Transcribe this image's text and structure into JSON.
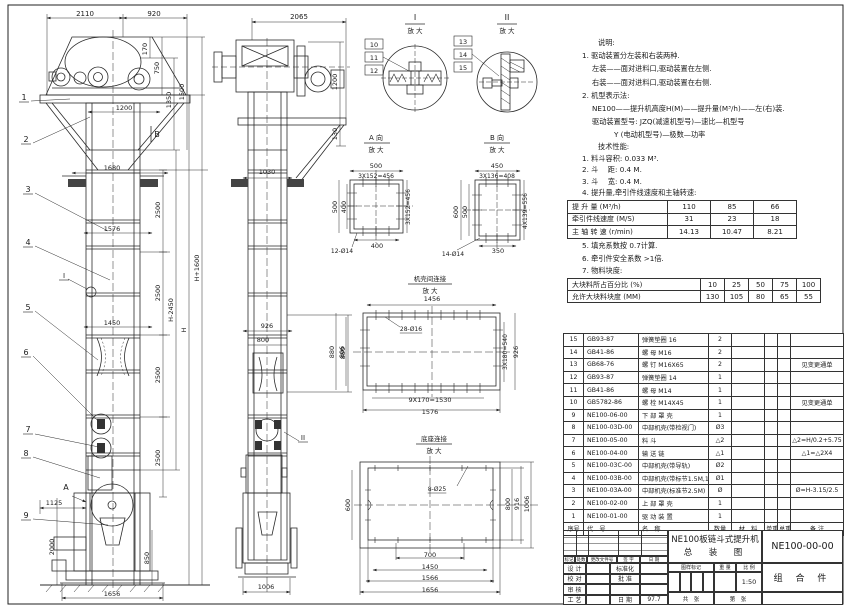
{
  "notes": {
    "title": "说明:",
    "lines": [
      "1. 驱动装置分左装和右装两种.",
      "左装——面对进料口,驱动装置在左侧.",
      "右装——面对进料口,驱动装置在右侧.",
      "2. 机型表示法:",
      "NE100——提升机高度H(M)——提升量(M³/h)——左(右)装.",
      "驱动装置型号: JZQ(减速机型号)—速比—机型号",
      "Y (电动机型号)—极数—功率"
    ]
  },
  "tech": {
    "title": "技术性能:",
    "items": [
      "1. 料斗容积: 0.033 M³.",
      "2. 斗　 距: 0.4 M.",
      "3. 斗　 宽: 0.4 M.",
      "4. 提升量,牵引件线速度和主轴转速:"
    ],
    "items2": [
      "5. 填充系数按 0.7计算.",
      "6. 牵引件安全系数 >1倍.",
      "7. 物料块度:"
    ]
  },
  "perf": {
    "rows": [
      [
        "提 升 量  (M³/h)",
        "110",
        "85",
        "66"
      ],
      [
        "牵引件线速度 (M/S)",
        "31",
        "23",
        "18"
      ],
      [
        "主 轴 转 速 (r/min)",
        "14.13",
        "10.47",
        "8.21"
      ]
    ]
  },
  "size": {
    "rows": [
      [
        "大块料所占百分比 (%)",
        "10",
        "25",
        "50",
        "75",
        "100"
      ],
      [
        "允许大块料块度 (MM)",
        "130",
        "105",
        "80",
        "65",
        "55"
      ]
    ]
  },
  "bom": {
    "rows": [
      [
        "15",
        "GB93-87",
        "弹簧垫圈 16",
        "2",
        "",
        "",
        "",
        ""
      ],
      [
        "14",
        "GB41-86",
        "螺 母 M16",
        "2",
        "",
        "",
        "",
        ""
      ],
      [
        "13",
        "GB68-76",
        "螺 钉 M16X65",
        "2",
        "",
        "",
        "",
        "见变更通单"
      ],
      [
        "12",
        "GB93-87",
        "弹簧垫圈 14",
        "1",
        "",
        "",
        "",
        ""
      ],
      [
        "11",
        "GB41-86",
        "螺 母 M14",
        "1",
        "",
        "",
        "",
        ""
      ],
      [
        "10",
        "GB5782-86",
        "螺 栓 M14X45",
        "1",
        "",
        "",
        "",
        "见变更通单"
      ],
      [
        "9",
        "NE100-06-00",
        "下 部 罩 壳",
        "1",
        "",
        "",
        "",
        ""
      ],
      [
        "8",
        "NE100-03D-00",
        "中部机壳(带检视门)",
        "Ø3",
        "",
        "",
        "",
        ""
      ],
      [
        "7",
        "NE100-05-00",
        "料 斗",
        "△2",
        "",
        "",
        "",
        "△2=H/0.2+5.75"
      ],
      [
        "6",
        "NE100-04-00",
        "输 送 链",
        "△1",
        "",
        "",
        "",
        "△1=△2X4"
      ],
      [
        "5",
        "NE100-03C-00",
        "中部机壳(带导轨)",
        "Ø2",
        "",
        "",
        "",
        ""
      ],
      [
        "4",
        "NE100-03B-00",
        "中部机壳(带标节1.5M,1M)",
        "Ø1",
        "",
        "",
        "",
        ""
      ],
      [
        "3",
        "NE100-03A-00",
        "中部机壳(标准节2.5M)",
        "Ø",
        "",
        "",
        "",
        "Ø=H-3.15/2.5"
      ],
      [
        "2",
        "NE100-02-00",
        "上 部 罩 壳",
        "1",
        "",
        "",
        "",
        ""
      ],
      [
        "1",
        "NE100-01-00",
        "驱 动 装 置",
        "1",
        "",
        "",
        "",
        ""
      ],
      [
        "序号",
        "代　号",
        "名　称",
        "数量",
        "材　料",
        "单重",
        "总重",
        "备 注"
      ]
    ]
  },
  "tb": {
    "mark": "标记",
    "qty": "处数",
    "doc": "更改文件号",
    "sign": "签 字",
    "date": "日 期",
    "design": "设 计",
    "check": "校 对",
    "review": "审 核",
    "craft": "工 艺",
    "std": "标准化",
    "approve": "批 准",
    "date2": "日 期",
    "date_val": "97.7",
    "title1": "NE100板链斗式提升机",
    "title2": "总　装　图",
    "stamp": "图样标记",
    "weight": "重 量",
    "scale_lbl": "比 例",
    "scale": "1:50",
    "sheets": "共　张",
    "sheet_no": "第　张",
    "dwg_no": "NE100-00-00",
    "part": "组 合 件"
  },
  "labels": [
    {
      "x": 85,
      "y": 16,
      "t": "2110"
    },
    {
      "x": 154,
      "y": 16,
      "t": "920"
    },
    {
      "x": 147,
      "y": 49,
      "t": "170",
      "r": 1,
      "fs": 6.5
    },
    {
      "x": 159,
      "y": 68,
      "t": "750",
      "r": 1,
      "fs": 6.5
    },
    {
      "x": 171,
      "y": 100,
      "t": "1350",
      "r": 1,
      "fs": 6.5
    },
    {
      "x": 184,
      "y": 92,
      "t": "1500",
      "r": 1,
      "fs": 6.5
    },
    {
      "x": 124,
      "y": 110,
      "t": "1200",
      "fs": 6.5
    },
    {
      "x": 112,
      "y": 170,
      "t": "1680",
      "fs": 6.5
    },
    {
      "x": 112,
      "y": 231,
      "t": "1576",
      "fs": 6.5
    },
    {
      "x": 112,
      "y": 325,
      "t": "1450",
      "fs": 6.5
    },
    {
      "x": 160,
      "y": 210,
      "t": "2500",
      "r": 1,
      "fs": 6.5
    },
    {
      "x": 160,
      "y": 293,
      "t": "2500",
      "r": 1,
      "fs": 6.5
    },
    {
      "x": 160,
      "y": 375,
      "t": "2500",
      "r": 1,
      "fs": 6.5
    },
    {
      "x": 160,
      "y": 458,
      "t": "2500",
      "r": 1,
      "fs": 6.5
    },
    {
      "x": 173,
      "y": 310,
      "t": "H-2450",
      "r": 1,
      "fs": 6.5
    },
    {
      "x": 186,
      "y": 330,
      "t": "H",
      "r": 1,
      "fs": 6.5
    },
    {
      "x": 199,
      "y": 268,
      "t": "H+1600",
      "r": 1,
      "fs": 6.5
    },
    {
      "x": 54,
      "y": 505,
      "t": "1125",
      "fs": 6.5
    },
    {
      "x": 54,
      "y": 547,
      "t": "2000",
      "r": 1,
      "fs": 6.5
    },
    {
      "x": 149,
      "y": 558,
      "t": "850",
      "r": 1,
      "fs": 6.5
    },
    {
      "x": 112,
      "y": 596,
      "t": "1656",
      "fs": 6.5
    },
    {
      "x": 24,
      "y": 100,
      "t": "1",
      "u": 1,
      "fs": 8
    },
    {
      "x": 26,
      "y": 142,
      "t": "2",
      "u": 1,
      "fs": 8
    },
    {
      "x": 28,
      "y": 192,
      "t": "3",
      "u": 1,
      "fs": 8
    },
    {
      "x": 28,
      "y": 245,
      "t": "4",
      "u": 1,
      "fs": 8
    },
    {
      "x": 28,
      "y": 310,
      "t": "5",
      "u": 1,
      "fs": 8
    },
    {
      "x": 26,
      "y": 355,
      "t": "6",
      "u": 1,
      "fs": 8
    },
    {
      "x": 28,
      "y": 432,
      "t": "7",
      "u": 1,
      "fs": 8
    },
    {
      "x": 26,
      "y": 456,
      "t": "8",
      "u": 1,
      "fs": 8
    },
    {
      "x": 26,
      "y": 518,
      "t": "9",
      "u": 1,
      "fs": 8
    },
    {
      "x": 64,
      "y": 278,
      "t": "I",
      "u": 1,
      "fs": 7
    },
    {
      "x": 66,
      "y": 490,
      "t": "A",
      "fs": 8
    },
    {
      "x": 157,
      "y": 137,
      "t": "B",
      "fs": 8
    },
    {
      "x": 299,
      "y": 19,
      "t": "2065"
    },
    {
      "x": 337,
      "y": 82,
      "t": "1200",
      "r": 1,
      "fs": 6.5
    },
    {
      "x": 337,
      "y": 134,
      "t": "130",
      "r": 1,
      "fs": 6.5
    },
    {
      "x": 267,
      "y": 174,
      "t": "1030",
      "fs": 6.5
    },
    {
      "x": 267,
      "y": 328,
      "t": "926",
      "fs": 6.5
    },
    {
      "x": 263,
      "y": 342,
      "t": "800",
      "fs": 6.5
    },
    {
      "x": 345,
      "y": 353,
      "t": "880",
      "r": 1,
      "fs": 6.5
    },
    {
      "x": 266,
      "y": 589,
      "t": "1006",
      "fs": 6.5
    },
    {
      "x": 303,
      "y": 440,
      "t": "II",
      "u": 1,
      "fs": 7
    },
    {
      "x": 415,
      "y": 20,
      "t": "I",
      "fs": 8
    },
    {
      "x": 415,
      "y": 33,
      "t": "放 大",
      "fs": 6.5
    },
    {
      "x": 374,
      "y": 47,
      "t": "10",
      "fs": 6.5
    },
    {
      "x": 374,
      "y": 60,
      "t": "11",
      "fs": 6.5
    },
    {
      "x": 374,
      "y": 73,
      "t": "12",
      "fs": 6.5
    },
    {
      "x": 507,
      "y": 20,
      "t": "II",
      "fs": 8
    },
    {
      "x": 507,
      "y": 33,
      "t": "放 大",
      "fs": 6.5
    },
    {
      "x": 463,
      "y": 44,
      "t": "13",
      "fs": 6.5
    },
    {
      "x": 463,
      "y": 57,
      "t": "14",
      "fs": 6.5
    },
    {
      "x": 463,
      "y": 70,
      "t": "15",
      "fs": 6.5
    },
    {
      "x": 376,
      "y": 140,
      "t": "A 向",
      "fs": 7
    },
    {
      "x": 376,
      "y": 152,
      "t": "放 大",
      "fs": 6.5
    },
    {
      "x": 376,
      "y": 168,
      "t": "500",
      "fs": 6.5
    },
    {
      "x": 376,
      "y": 178,
      "t": "3X152=456",
      "fs": 6,
      "u": 1
    },
    {
      "x": 337,
      "y": 207,
      "t": "500",
      "r": 1,
      "fs": 6.5
    },
    {
      "x": 346,
      "y": 207,
      "t": "400",
      "r": 1,
      "fs": 6.5
    },
    {
      "x": 410,
      "y": 207,
      "t": "3X152=456",
      "r": 1,
      "fs": 6
    },
    {
      "x": 377,
      "y": 248,
      "t": "400",
      "fs": 6.5
    },
    {
      "x": 342,
      "y": 253,
      "t": "12-Ø14",
      "fs": 6
    },
    {
      "x": 497,
      "y": 140,
      "t": "B 向",
      "fs": 7
    },
    {
      "x": 497,
      "y": 152,
      "t": "放 大",
      "fs": 6.5
    },
    {
      "x": 497,
      "y": 168,
      "t": "450",
      "fs": 6.5
    },
    {
      "x": 497,
      "y": 178,
      "t": "3X136=408",
      "fs": 6,
      "u": 1
    },
    {
      "x": 458,
      "y": 212,
      "t": "600",
      "r": 1,
      "fs": 6.5
    },
    {
      "x": 467,
      "y": 212,
      "t": "500",
      "r": 1,
      "fs": 6.5
    },
    {
      "x": 527,
      "y": 211,
      "t": "4X139=556",
      "r": 1,
      "fs": 6
    },
    {
      "x": 498,
      "y": 253,
      "t": "350",
      "fs": 6.5
    },
    {
      "x": 453,
      "y": 256,
      "t": "14-Ø14",
      "fs": 6
    },
    {
      "x": 430,
      "y": 281,
      "t": "机壳间连接",
      "fs": 6.5
    },
    {
      "x": 430,
      "y": 293,
      "t": "放 大",
      "fs": 6.5
    },
    {
      "x": 432,
      "y": 301,
      "t": "1456",
      "fs": 6.5
    },
    {
      "x": 411,
      "y": 331,
      "t": "28-Ø16",
      "fs": 6,
      "u": 1
    },
    {
      "x": 334,
      "y": 352,
      "t": "880",
      "r": 1,
      "fs": 6.5
    },
    {
      "x": 344,
      "y": 352,
      "t": "806",
      "r": 1,
      "fs": 6.5
    },
    {
      "x": 507,
      "y": 352,
      "t": "3X180=540",
      "r": 1,
      "fs": 6
    },
    {
      "x": 518,
      "y": 352,
      "t": "926",
      "r": 1,
      "fs": 6.5
    },
    {
      "x": 430,
      "y": 402,
      "t": "9X170=1530",
      "fs": 6.5
    },
    {
      "x": 430,
      "y": 414,
      "t": "1576",
      "fs": 6.5
    },
    {
      "x": 434,
      "y": 441,
      "t": "底座连接",
      "fs": 6.5
    },
    {
      "x": 434,
      "y": 453,
      "t": "放 大",
      "fs": 6.5
    },
    {
      "x": 437,
      "y": 491,
      "t": "8-Ø25",
      "fs": 6,
      "u": 1
    },
    {
      "x": 350,
      "y": 505,
      "t": "600",
      "r": 1,
      "fs": 6.5
    },
    {
      "x": 510,
      "y": 504,
      "t": "800",
      "r": 1,
      "fs": 6.5
    },
    {
      "x": 519,
      "y": 504,
      "t": "916",
      "r": 1,
      "fs": 6.5
    },
    {
      "x": 529,
      "y": 504,
      "t": "1006",
      "r": 1,
      "fs": 6.5
    },
    {
      "x": 430,
      "y": 557,
      "t": "700",
      "fs": 6.5
    },
    {
      "x": 430,
      "y": 569,
      "t": "1450",
      "fs": 6.5
    },
    {
      "x": 430,
      "y": 580,
      "t": "1566",
      "fs": 6.5
    },
    {
      "x": 430,
      "y": 592,
      "t": "1656",
      "fs": 6.5
    }
  ]
}
